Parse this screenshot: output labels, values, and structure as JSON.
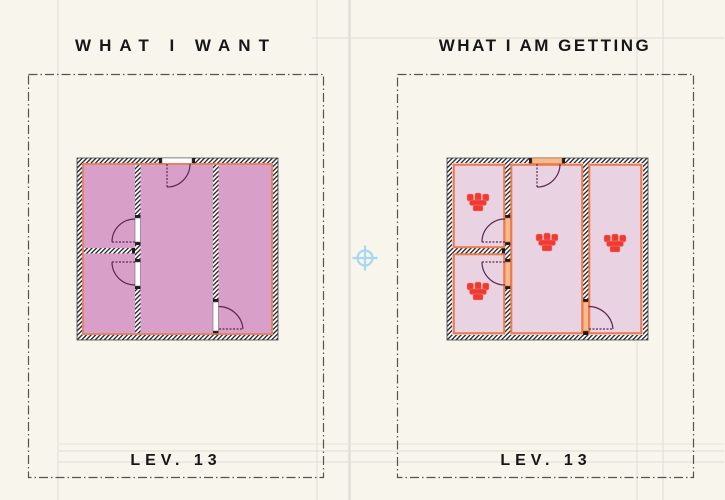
{
  "app": {
    "background_color": "#f8f5ec",
    "sheet_frame_line_color": "#deddd6"
  },
  "left_sheet": {
    "title": "WHAT I WANT",
    "level_label": "LEV. 13",
    "plan": {
      "fill_color": "#d89fc9",
      "wall_outline_color": "#ed7b4d",
      "door_swing_color": "#5a2950"
    }
  },
  "right_sheet": {
    "title": "WHAT I AM GETTING",
    "level_label": "LEV. 13",
    "plan": {
      "fill_color": "#e9d2e2",
      "room_outline_color": "#ed7b4d",
      "door_leaf_fill_color": "#f6ba8c",
      "door_swing_color": "#5a2950",
      "zone_stamp_color": "#ee3a31",
      "zone_stamp_count": 4
    }
  },
  "viewport": {
    "marquee_border_color": "#58534d",
    "origin_marker_color": "#a6d7f3"
  },
  "icons": {
    "origin_marker": "origin-crosshair-icon",
    "zone_stamp": "zone-stamp-icon"
  }
}
